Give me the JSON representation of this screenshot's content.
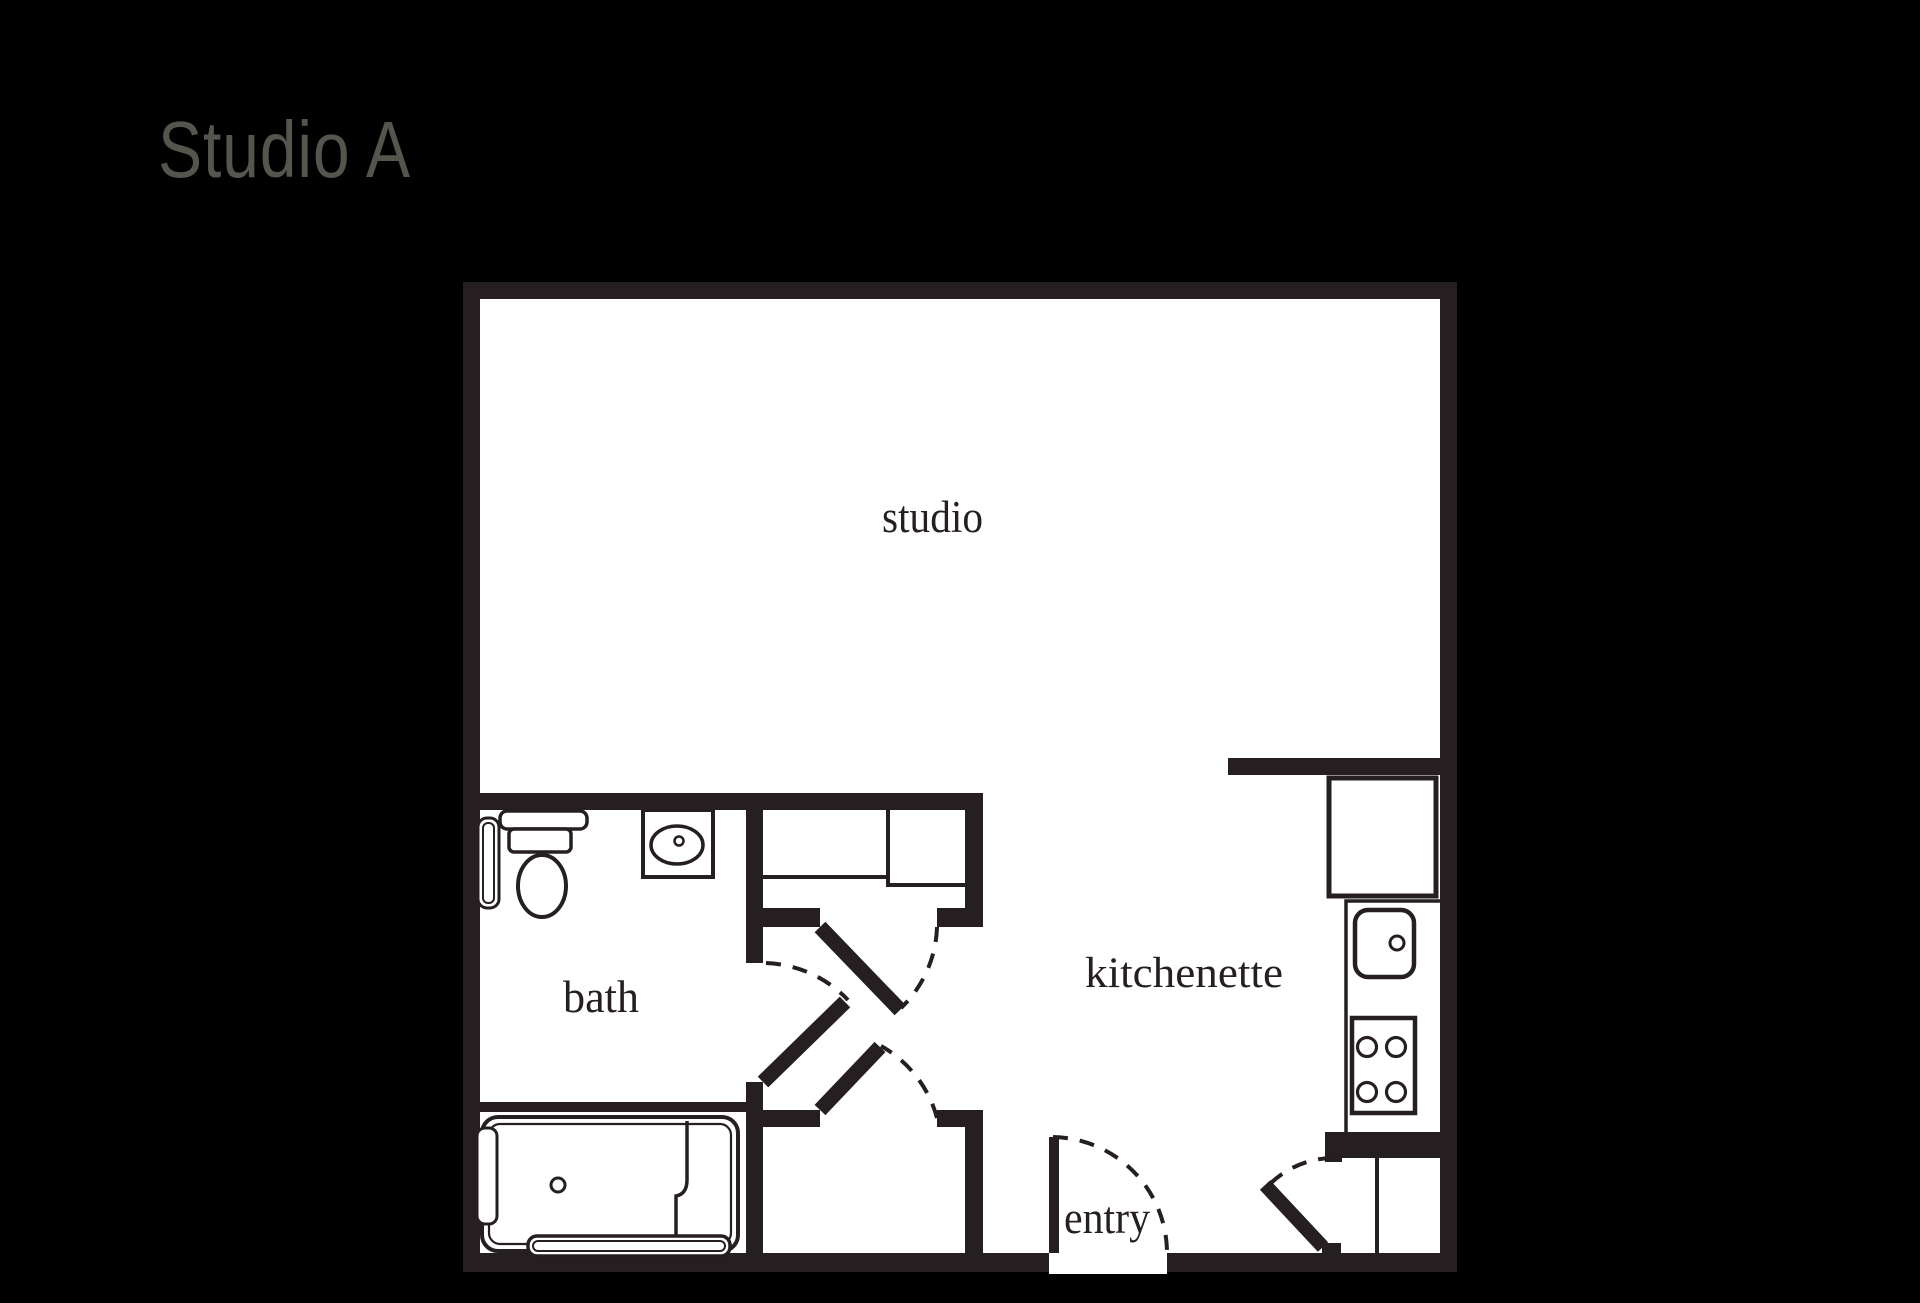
{
  "page_title": "Studio A",
  "floor_plan": {
    "rooms": [
      {
        "label": "studio"
      },
      {
        "label": "bath"
      },
      {
        "label": "kitchenette"
      },
      {
        "label": "entry"
      }
    ]
  },
  "colors": {
    "background": "#000000",
    "wall": "#251f21",
    "floor": "#ffffff",
    "title_text": "#56554d",
    "label_text": "#251f21"
  }
}
